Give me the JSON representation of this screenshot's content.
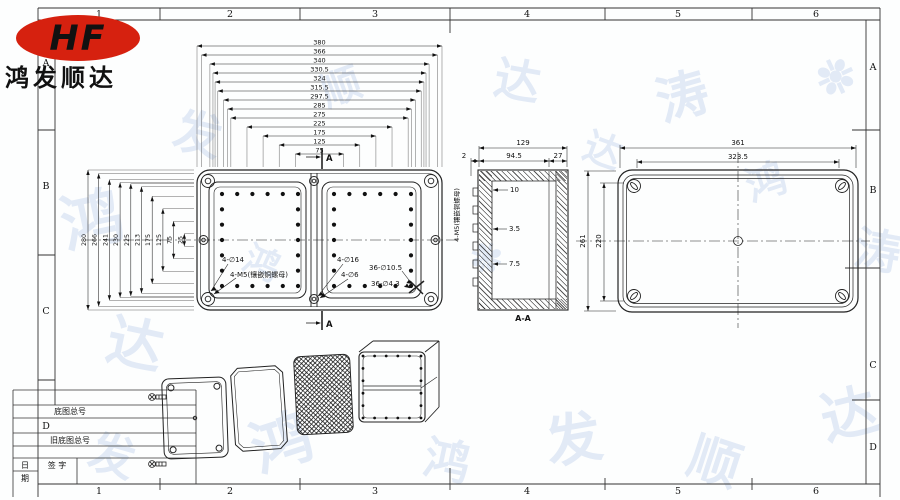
{
  "logo": {
    "text": "HF",
    "company": "鸿发顺达",
    "color": "#d6210f"
  },
  "frame": {
    "cols": [
      "1",
      "2",
      "3",
      "4",
      "5",
      "6"
    ],
    "rows": [
      "A",
      "B",
      "C",
      "D"
    ]
  },
  "title_block": {
    "row1": "底图总号",
    "row2": "旧底图总号",
    "sign_left": "日",
    "sign_right": "签  字",
    "sign_bottom": "期",
    "zone": "D"
  },
  "front_view": {
    "top_chain": [
      "380",
      "366",
      "340",
      "330.5",
      "324",
      "315.5",
      "297.5",
      "285",
      "275",
      "225",
      "175",
      "125",
      "75"
    ],
    "left_chain": [
      "280",
      "266",
      "241",
      "230",
      "225",
      "213",
      "175",
      "125",
      "75",
      "25"
    ],
    "ann_corner_hole": "4-∅14",
    "ann_corner_insert": "4-M5(镶嵌铜螺母)",
    "ann_mid_hole": "4-∅16",
    "ann_mid_hole2": "4-∅6",
    "ann_grid_hole1": "36-∅10.5",
    "ann_grid_hole2": "36-∅4.3",
    "section": "A"
  },
  "section_view": {
    "d_total": "129",
    "d_left": "2",
    "d_body": "94.5",
    "d_lid": "27",
    "d_rib1": "10",
    "d_rib2": "3.5",
    "d_rib3": "7.5",
    "label": "A-A",
    "side_note": "4-M5(镶嵌铜螺母)"
  },
  "top_view": {
    "w_outer": "361",
    "w_inner": "323.5",
    "h_outer": "261",
    "h_inner": "220"
  },
  "watermark": {
    "chars": "鸿发顺达涛❉达鸿",
    "color": "rgba(120,155,214,0.20)"
  }
}
